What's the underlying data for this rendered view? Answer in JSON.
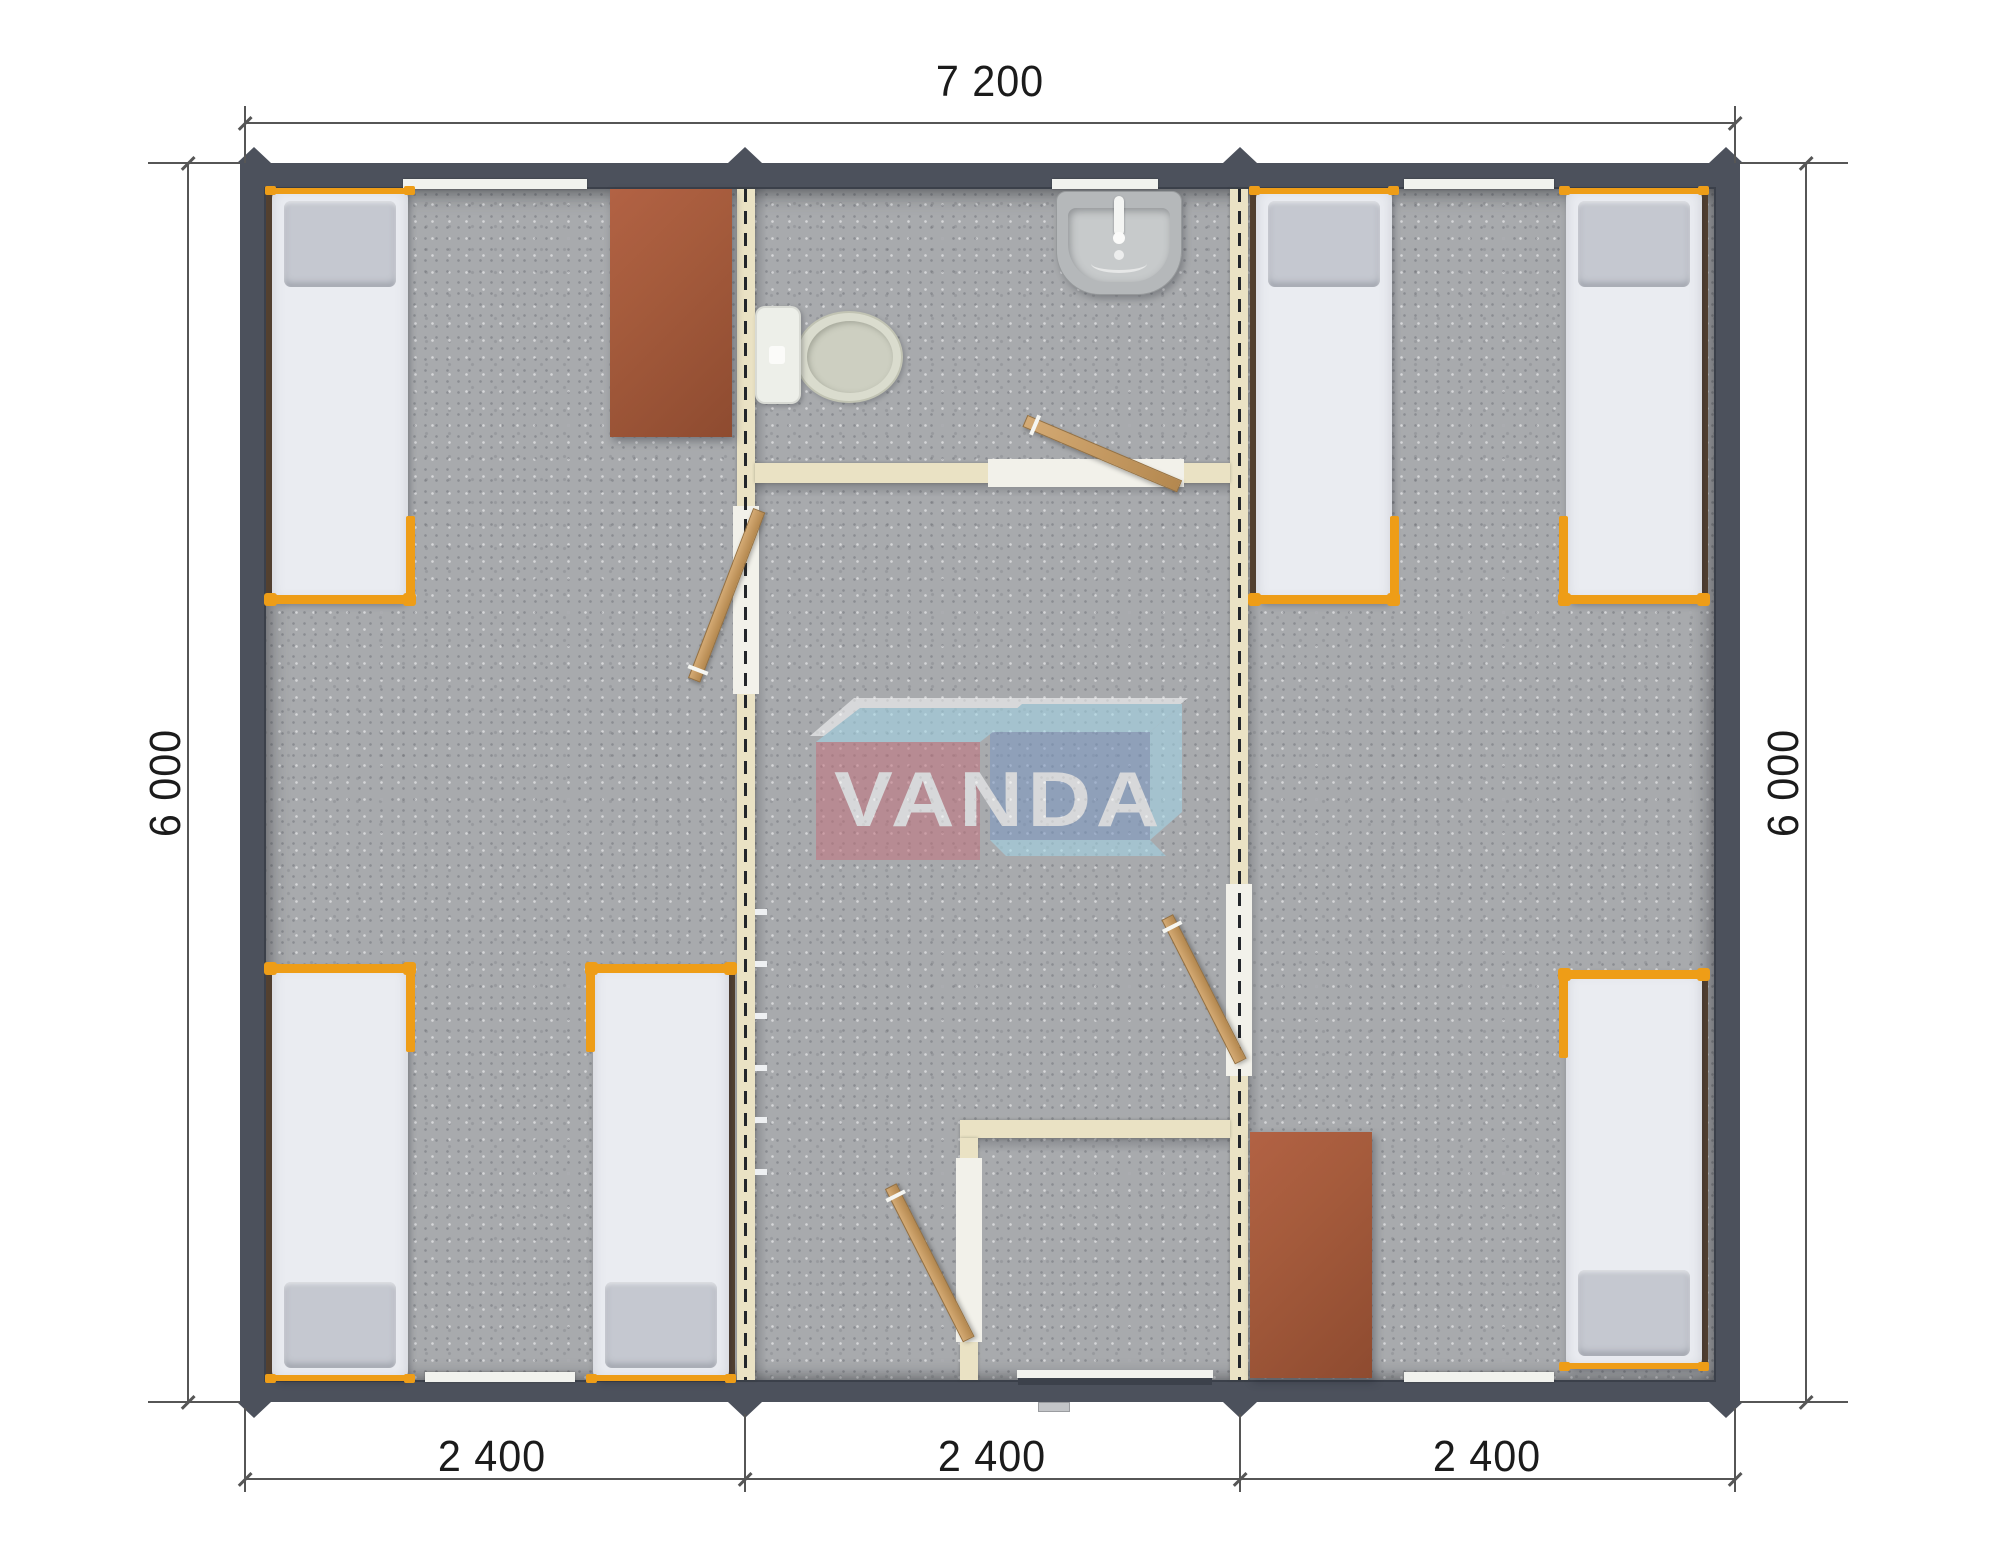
{
  "dimensions": {
    "top": "7 200",
    "left": "6 000",
    "right": "6 000",
    "bottom": [
      "2 400",
      "2 400",
      "2 400"
    ]
  },
  "watermark": {
    "text": "VANDA"
  },
  "colors": {
    "wall": "#4c515c",
    "floor": "#a8aaad",
    "partition": "#eae2c4",
    "threshold": "#f2f1ea",
    "door_wood": "#c49a66",
    "bed_frame": "#ee9d17",
    "bed_base": "#544130",
    "bed_mattress": "#eaecf1",
    "bed_pillow": "#c5c8d0",
    "desk": "#a55b3c",
    "ceramic": "#edefe9",
    "sink": "#b5b8ba",
    "logo_red": "#c4737e",
    "logo_blue": "#7b98c3",
    "logo_sky": "#a2d7e9",
    "dim_line": "#565656",
    "dim_text": "#1b1b1b"
  }
}
